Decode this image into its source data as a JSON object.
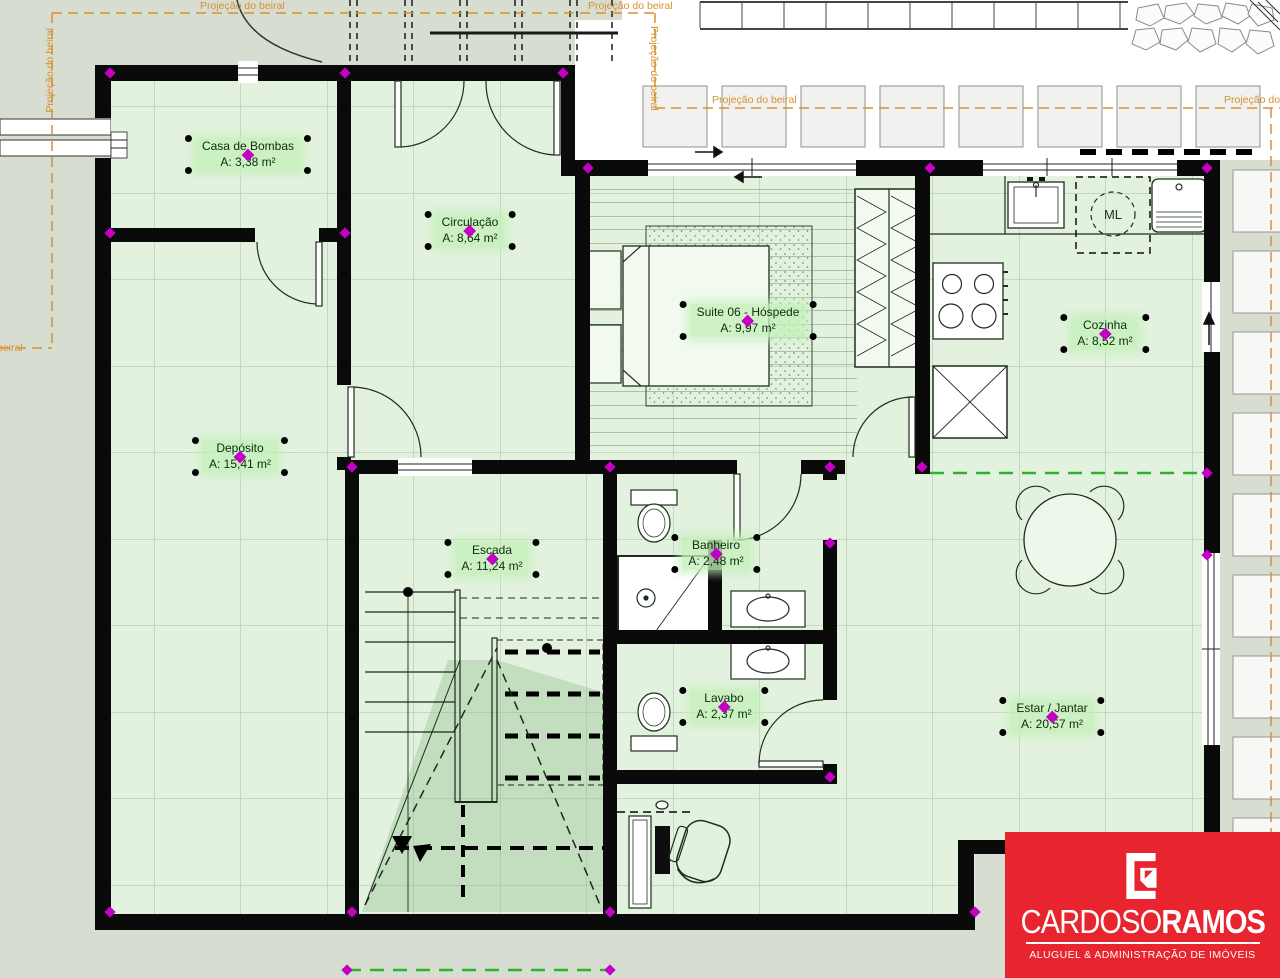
{
  "plan": {
    "rooms": [
      {
        "id": "casa-de-bombas",
        "name": "Casa de Bombas",
        "area": "A: 3,38 m²"
      },
      {
        "id": "circulacao",
        "name": "Circulação",
        "area": "A: 8,64 m²"
      },
      {
        "id": "suite-06",
        "name": "Suite 06 - Hóspede",
        "area": "A: 9,97 m²"
      },
      {
        "id": "cozinha",
        "name": "Cozinha",
        "area": "A: 8,52 m²"
      },
      {
        "id": "deposito",
        "name": "Depósito",
        "area": "A: 15,41 m²"
      },
      {
        "id": "escada",
        "name": "Escada",
        "area": "A: 11,24 m²"
      },
      {
        "id": "banheiro",
        "name": "Banheiro",
        "area": "A: 2,48 m²"
      },
      {
        "id": "lavabo",
        "name": "Lavabo",
        "area": "A: 2,37 m²"
      },
      {
        "id": "estar-jantar",
        "name": "Estar / Jantar",
        "area": "A: 20,57 m²"
      }
    ],
    "eave_label": "Projeção do beiral",
    "washer_label": "ML"
  },
  "logo": {
    "brand_primary": "CARDOSO",
    "brand_secondary": "RAMOS",
    "tagline": "ALUGUEL & ADMINISTRAÇÃO DE IMÓVEIS",
    "background": "#e8242e"
  },
  "colors": {
    "wall": "#0a0a0a",
    "floor_fill": "#e3f2df",
    "outside": "#d8ddd1",
    "selection_magenta": "#c400c4",
    "eave_orange": "#d8902f",
    "reference_green": "#2db32d",
    "label_highlight": "#c6eec0",
    "logo_red": "#e8242e"
  }
}
